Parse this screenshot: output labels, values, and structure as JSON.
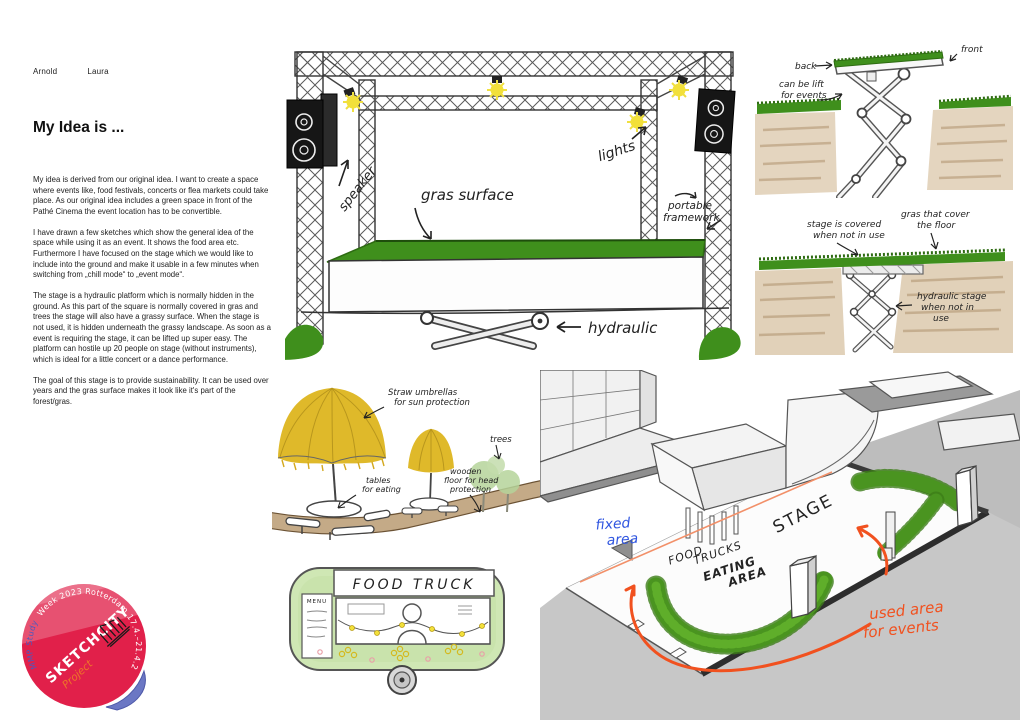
{
  "authors": [
    "Arnold",
    "Laura"
  ],
  "article": {
    "title": "My Idea is ...",
    "paragraphs": [
      "My idea is derived from our original idea. I want to create a space where events like, food festivals, concerts or flea markets could take place. As our original idea includes a green space in front of the Pathé Cinema the event location has to be convertible.",
      "I have drawn a few sketches which show the general idea of the space while using it as an event. It shows the food area etc. Furthermore I have focused on the stage which we would like to include into the ground and make it usable in a few minutes when switching from „chill mode“ to „event mode“.",
      "The stage is a hydraulic platform which is normally hidden in the ground. As this part of the square is normally covered in gras and trees the stage will also have a grassy surface. When the stage is not used, it is hidden underneath the grassy landscape. As soon as a event is requiring the stage, it can be lifted up super easy. The platform can hostile up 20 people on stage (without instruments), which is ideal for a little concert or a dance performance.",
      "The goal of this stage is to provide sustainability. It can be used over years and the gras surface makes it look like it's part of the forest/gras."
    ]
  },
  "sketches": {
    "stage": {
      "speaker": "speaker",
      "gras_surface": "gras surface",
      "lights": "lights",
      "portable": [
        "portable",
        "framework"
      ],
      "hydraulic": "hydraulic"
    },
    "lift_raised": {
      "front": "front",
      "back": "back",
      "note": [
        "can be lift",
        "for events"
      ]
    },
    "lift_lowered": {
      "covered": [
        "stage is covered",
        "when not in use"
      ],
      "gras": [
        "gras that cover",
        "the floor"
      ],
      "hydraulic": [
        "hydraulic stage",
        "when not in",
        "use"
      ]
    },
    "food_area": {
      "umbrellas": [
        "Straw umbrellas",
        "for sun protection"
      ],
      "tables": [
        "tables",
        "for eating"
      ],
      "trees": "trees",
      "floor": [
        "wooden",
        "floor for head",
        "protection"
      ]
    },
    "food_truck": {
      "sign": "FOOD TRUCK",
      "menu": "MENU"
    },
    "site_plan": {
      "fixed": [
        "fixed",
        "area"
      ],
      "food_trucks": [
        "FOOD",
        "TRUCKS"
      ],
      "stage": "STAGE",
      "eating": [
        "EATING",
        "AREA"
      ],
      "used": [
        "used area",
        "for events"
      ]
    }
  },
  "sticker": {
    "arc_blue": "MMP Study ",
    "arc_white": "Week 2023 Rotterdam 17.4.–21.4.2023",
    "brand": "SKETCHCITY",
    "project": "Project"
  },
  "colors": {
    "grass_green": "#3f8f1c",
    "light_yellow": "#f2e03a",
    "umbrella_yellow": "#dfb92a",
    "ground_brown": "#c9ab80",
    "annotation_orange": "#f1511f",
    "annotation_blue": "#2f55e0",
    "sticker_red": "#e1204a",
    "sticker_fold_blue": "#6b77c4"
  }
}
